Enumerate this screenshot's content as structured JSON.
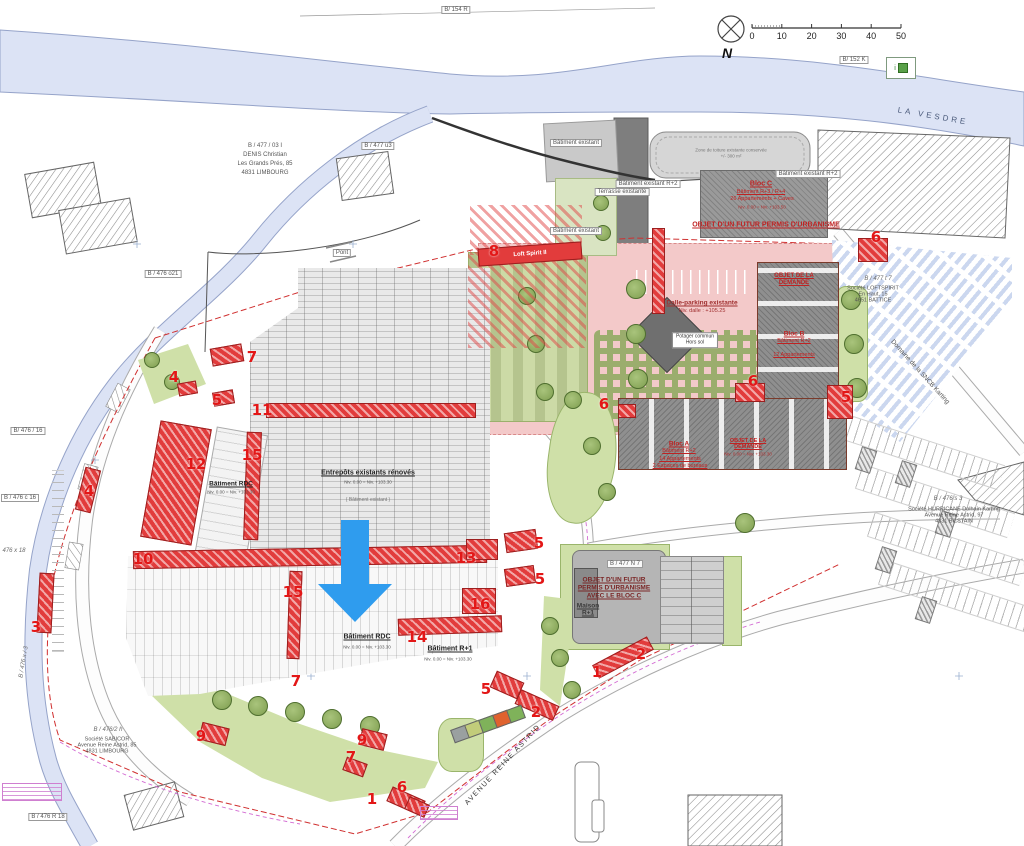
{
  "compass": {
    "north": "N"
  },
  "scalebar": {
    "ticks": [
      "0",
      "10",
      "20",
      "30",
      "40",
      "50"
    ]
  },
  "legend": {
    "icon_text": "i"
  },
  "river": {
    "label": "LA VESDRE"
  },
  "roads": {
    "avenue": "AVENUE REINE ASTRID",
    "domaine": "Domaine de la SNCB Karting"
  },
  "parcels": [
    {
      "t": "B/ 154 R",
      "x": 456,
      "y": 10,
      "r": 0,
      "box": true
    },
    {
      "t": "B/ 152 K",
      "x": 854,
      "y": 60,
      "r": 0,
      "box": true
    },
    {
      "t": "B / 477 u3",
      "x": 378,
      "y": 146,
      "r": 0,
      "box": true
    },
    {
      "t": "B / 476 o21",
      "x": 163,
      "y": 274,
      "r": 0,
      "box": true
    },
    {
      "t": "Pont",
      "x": 342,
      "y": 253,
      "r": 0,
      "box": true
    },
    {
      "t": "B/ 476 / 16",
      "x": 28,
      "y": 431,
      "r": 0,
      "box": true
    },
    {
      "t": "B / 476 c 16",
      "x": 20,
      "y": 498,
      "r": 0,
      "box": true
    },
    {
      "t": "476 x 18",
      "x": 14,
      "y": 551,
      "r": 0,
      "box": false
    },
    {
      "t": "B / 476 x / 3",
      "x": 24,
      "y": 662,
      "r": -80,
      "box": false
    },
    {
      "t": "B / 476 R 18",
      "x": 48,
      "y": 817,
      "r": 0,
      "box": true
    },
    {
      "t": "B / 477 t 7",
      "x": 878,
      "y": 279,
      "r": 0,
      "box": false
    },
    {
      "t": "B / 476 s 3",
      "x": 948,
      "y": 499,
      "r": 0,
      "box": false
    },
    {
      "t": "B / 477 N 7",
      "x": 625,
      "y": 564,
      "r": 0,
      "box": true
    },
    {
      "t": "B / 476/2 h",
      "x": 108,
      "y": 730,
      "r": 0,
      "box": false
    }
  ],
  "owners": {
    "denis": {
      "lines": [
        "B / 477 / 03 I",
        "DENIS Christian",
        "Les Grands Prés, 85",
        "4831 LIMBOURG"
      ]
    },
    "loftspirit": {
      "lines": [
        "Société LOFTSPIRIT",
        "En Haut, 15",
        "4651 BATTICE"
      ]
    },
    "hurricane": {
      "lines": [
        "Société HURRICANE Dolhain Karting",
        "Avenue Reine Astrid, 97",
        "4831 BILSTAIN"
      ]
    },
    "sabicor": {
      "lines": [
        "Société SABICOR",
        "Avenue Reine Astrid, 85",
        "4831 LIMBOURG"
      ]
    }
  },
  "existing_labels": [
    {
      "t": "Bâtiment existant",
      "x": 576,
      "y": 143
    },
    {
      "t": "Bâtiment existant",
      "x": 576,
      "y": 231
    },
    {
      "t": "Terrasse existante",
      "x": 622,
      "y": 192
    },
    {
      "t": "Bâtiment existant R+2",
      "x": 648,
      "y": 184
    },
    {
      "t": "Bâtiment existant R+2",
      "x": 808,
      "y": 174
    }
  ],
  "roof_note": {
    "l1": "Zone de toiture existante conservée",
    "l2": "+/- 300 m²"
  },
  "loft_band": "Loft Spirit II",
  "warehouse": {
    "title": "Entrepôts existants rénovés",
    "niv": "Niv. 0.00 = Niv. +103.30",
    "note": "( Bâtiment existant )"
  },
  "batiments": {
    "rdc1": {
      "title": "Bâtiment RDC",
      "niv": "Niv. 0.00 = Niv. +103.30"
    },
    "rdc2": {
      "title": "Bâtiment RDC",
      "niv": "Niv. 0.00 = Niv. +103.30"
    },
    "r1": {
      "title": "Bâtiment R+1",
      "niv": "Niv. 0.00 = Niv. +103.30"
    }
  },
  "blocs": {
    "c": {
      "title": "Bloc C",
      "l1": "Bâtiment R+3 / R+4",
      "l2": "26 Appartements + Caves",
      "niv": "Niv. 0.00 = Niv. +103.50",
      "objet": "OBJET D'UN FUTUR PERMIS D'URBANISME"
    },
    "b": {
      "objet1": "OBJET DE LA",
      "objet2": "DEMANDE",
      "title": "Bloc B",
      "l1": "Bâtiment R+2",
      "l2": "12 Appartements"
    },
    "a": {
      "title": "Bloc A",
      "l1": "Bâtiment R+2",
      "l2": "14 Appartements",
      "l3": "2 Espaces de bureaux",
      "objet1": "OBJET DE LA",
      "objet2": "DEMANDE",
      "niv": "Niv. 0.00 = Niv. +103.30"
    }
  },
  "futur": {
    "l1": "OBJET D'UN FUTUR",
    "l2": "PERMIS D'URBANISME",
    "l3": "AVEC LE BLOC C",
    "maison1": "Maison",
    "maison2": "R+1"
  },
  "dalle": {
    "l1": "Dalle-parking existante",
    "l2": "Niv. dalle : +105.25",
    "potager1": "Potager commun",
    "potager2": "Hors sol"
  },
  "markers": [
    {
      "n": "8",
      "x": 494,
      "y": 251
    },
    {
      "n": "6",
      "x": 876,
      "y": 237
    },
    {
      "n": "7",
      "x": 252,
      "y": 357
    },
    {
      "n": "4",
      "x": 174,
      "y": 377
    },
    {
      "n": "5",
      "x": 217,
      "y": 400
    },
    {
      "n": "11",
      "x": 262,
      "y": 410
    },
    {
      "n": "6",
      "x": 604,
      "y": 404
    },
    {
      "n": "6",
      "x": 753,
      "y": 381
    },
    {
      "n": "5",
      "x": 846,
      "y": 397
    },
    {
      "n": "15",
      "x": 252,
      "y": 455
    },
    {
      "n": "12",
      "x": 196,
      "y": 464
    },
    {
      "n": "4",
      "x": 89,
      "y": 491
    },
    {
      "n": "10",
      "x": 143,
      "y": 559
    },
    {
      "n": "13",
      "x": 466,
      "y": 558
    },
    {
      "n": "5",
      "x": 539,
      "y": 543
    },
    {
      "n": "5",
      "x": 540,
      "y": 579
    },
    {
      "n": "16",
      "x": 480,
      "y": 604
    },
    {
      "n": "15",
      "x": 293,
      "y": 592
    },
    {
      "n": "3",
      "x": 36,
      "y": 627
    },
    {
      "n": "14",
      "x": 417,
      "y": 637
    },
    {
      "n": "2",
      "x": 641,
      "y": 654
    },
    {
      "n": "1",
      "x": 597,
      "y": 672
    },
    {
      "n": "7",
      "x": 296,
      "y": 681
    },
    {
      "n": "5",
      "x": 486,
      "y": 689
    },
    {
      "n": "2",
      "x": 536,
      "y": 712
    },
    {
      "n": "9",
      "x": 201,
      "y": 736
    },
    {
      "n": "9",
      "x": 362,
      "y": 740
    },
    {
      "n": "7",
      "x": 351,
      "y": 757
    },
    {
      "n": "6",
      "x": 402,
      "y": 787
    },
    {
      "n": "1",
      "x": 372,
      "y": 799
    }
  ],
  "red_blocks": [
    [
      266,
      403,
      208,
      13,
      0
    ],
    [
      133,
      548,
      352,
      16,
      -1
    ],
    [
      150,
      424,
      50,
      116,
      10
    ],
    [
      245,
      432,
      13,
      106,
      2
    ],
    [
      288,
      571,
      11,
      86,
      2
    ],
    [
      398,
      617,
      102,
      15,
      -2
    ],
    [
      462,
      588,
      32,
      24,
      0
    ],
    [
      466,
      539,
      30,
      19,
      0
    ],
    [
      505,
      531,
      30,
      18,
      -8
    ],
    [
      505,
      567,
      28,
      16,
      -8
    ],
    [
      492,
      676,
      28,
      16,
      24
    ],
    [
      516,
      697,
      40,
      14,
      24
    ],
    [
      211,
      346,
      30,
      16,
      -10
    ],
    [
      178,
      382,
      17,
      11,
      -10
    ],
    [
      213,
      391,
      19,
      12,
      -10
    ],
    [
      80,
      468,
      14,
      42,
      14
    ],
    [
      38,
      573,
      13,
      58,
      3
    ],
    [
      735,
      383,
      28,
      17,
      0
    ],
    [
      858,
      238,
      28,
      22,
      0
    ],
    [
      827,
      385,
      24,
      32,
      0
    ],
    [
      200,
      725,
      26,
      16,
      14
    ],
    [
      360,
      731,
      24,
      15,
      14
    ],
    [
      344,
      760,
      20,
      12,
      20
    ],
    [
      388,
      793,
      34,
      14,
      24
    ],
    [
      406,
      800,
      20,
      12,
      24
    ],
    [
      592,
      650,
      60,
      13,
      -28
    ],
    [
      652,
      228,
      11,
      84,
      0
    ],
    [
      618,
      404,
      16,
      12,
      0
    ]
  ],
  "trees": [
    [
      636,
      289,
      9
    ],
    [
      636,
      334,
      9
    ],
    [
      638,
      379,
      9
    ],
    [
      527,
      296,
      8
    ],
    [
      536,
      344,
      8
    ],
    [
      545,
      392,
      8
    ],
    [
      851,
      300,
      9
    ],
    [
      854,
      344,
      9
    ],
    [
      857,
      388,
      9
    ],
    [
      573,
      400,
      8
    ],
    [
      592,
      446,
      8
    ],
    [
      607,
      492,
      8
    ],
    [
      745,
      523,
      9
    ],
    [
      222,
      700,
      9
    ],
    [
      258,
      706,
      9
    ],
    [
      295,
      712,
      9
    ],
    [
      332,
      719,
      9
    ],
    [
      370,
      726,
      9
    ],
    [
      550,
      626,
      8
    ],
    [
      560,
      658,
      8
    ],
    [
      572,
      690,
      8
    ],
    [
      152,
      360,
      7
    ],
    [
      172,
      382,
      7
    ],
    [
      601,
      203,
      7
    ],
    [
      603,
      233,
      7
    ]
  ],
  "tiles": [
    [
      452,
      727,
      "#9aa0a0"
    ],
    [
      466,
      722,
      "#c2cc7a"
    ],
    [
      480,
      717,
      "#7fb25a"
    ],
    [
      494,
      712,
      "#e0622e"
    ],
    [
      508,
      707,
      "#7fb25a"
    ]
  ]
}
